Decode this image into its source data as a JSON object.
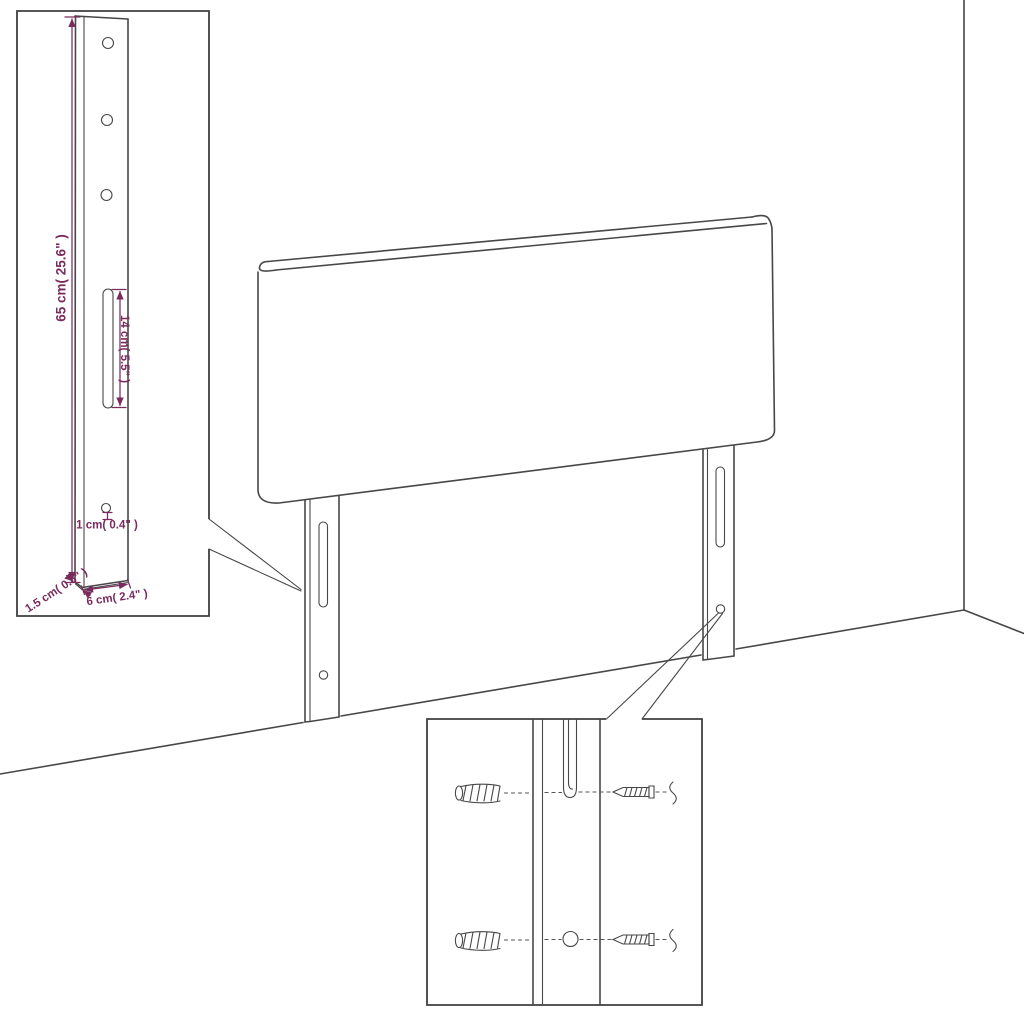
{
  "page": {
    "title": "Headboard assembly dimension diagram",
    "background": "#ffffff"
  },
  "colors": {
    "line": "#474747",
    "dimension": "#7a2b5d"
  },
  "main_drawing": {
    "object": "upholstered headboard panel with two mounting legs standing in a room corner",
    "legs": 2,
    "scene_parts": [
      "wall-corner-line",
      "floor-line",
      "headboard-panel",
      "left-leg",
      "right-leg"
    ]
  },
  "leg_detail_inset": {
    "description": "enlarged view of mounting leg",
    "holes_top": 3,
    "labels": {
      "leg_height": "65 cm( 25.6\" )",
      "slot_length": "14 cm( 5.5\" )",
      "hole_diameter": "1 cm( 0.4\" )",
      "leg_thickness": "1.5 cm( 0.6\" )",
      "leg_width": "6 cm( 2.4\" )"
    }
  },
  "mounting_detail_inset": {
    "description": "enlarged view of leg slot and hole with wall plugs and screws",
    "wall_plugs": 2,
    "screws": 2
  }
}
